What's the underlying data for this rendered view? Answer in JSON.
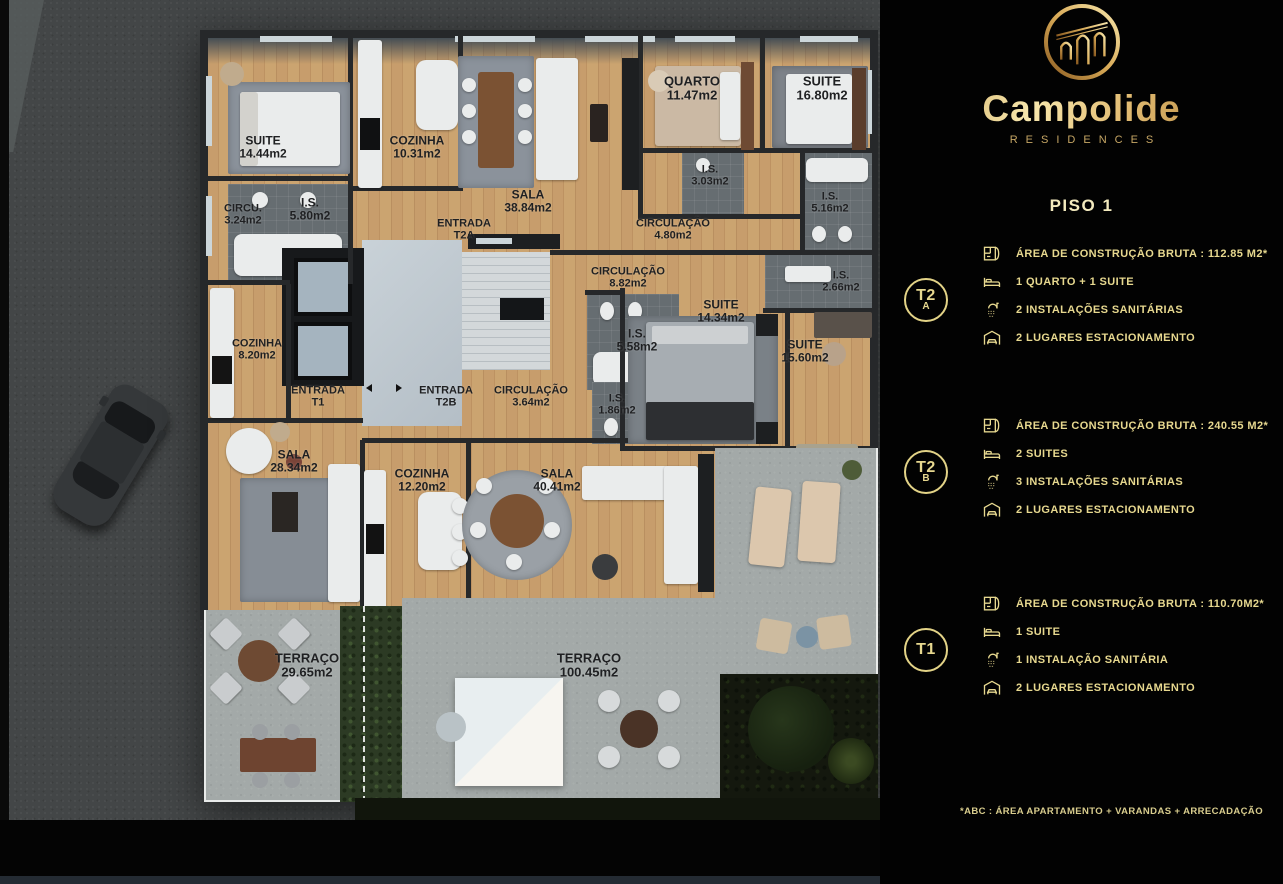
{
  "brand": {
    "name": "Campolide",
    "tagline": "RESIDENCES",
    "logo_icon": "aqueduct-arches-logo"
  },
  "page": {
    "floor_title": "PISO 1",
    "footnote": "*ABC :  ÁREA APARTAMENTO + VARANDAS + ARRECADAÇÃO"
  },
  "colors": {
    "accent_gold": "#e7d88f",
    "logo_gold": "#d3a554",
    "panel_bg": "#020202",
    "wood_floor": "#c49c6b",
    "terrace_concrete": "#a3a9a8"
  },
  "units": [
    {
      "badge_line1": "T2",
      "badge_line2": "A",
      "specs": [
        {
          "icon": "floorplan-icon",
          "text": "ÁREA DE CONSTRUÇÃO BRUTA :  112.85 M2*"
        },
        {
          "icon": "bed-icon",
          "text": "1 QUARTO + 1 SUITE"
        },
        {
          "icon": "shower-icon",
          "text": "2 INSTALAÇÕES SANITÁRIAS"
        },
        {
          "icon": "garage-icon",
          "text": "2 LUGARES ESTACIONAMENTO"
        }
      ]
    },
    {
      "badge_line1": "T2",
      "badge_line2": "B",
      "specs": [
        {
          "icon": "floorplan-icon",
          "text": "ÁREA DE CONSTRUÇÃO BRUTA :  240.55 M2*"
        },
        {
          "icon": "bed-icon",
          "text": "2 SUITES"
        },
        {
          "icon": "shower-icon",
          "text": "3 INSTALAÇÕES SANITÁRIAS"
        },
        {
          "icon": "garage-icon",
          "text": "2 LUGARES ESTACIONAMENTO"
        }
      ]
    },
    {
      "badge_line1": "T1",
      "badge_line2": "",
      "specs": [
        {
          "icon": "floorplan-icon",
          "text": "ÁREA DE CONSTRUÇÃO BRUTA :  110.70M2*"
        },
        {
          "icon": "bed-icon",
          "text": "1 SUITE"
        },
        {
          "icon": "shower-icon",
          "text": "1 INSTALAÇÃO SANITÁRIA"
        },
        {
          "icon": "garage-icon",
          "text": "2 LUGARES ESTACIONAMENTO"
        }
      ]
    }
  ],
  "floorplan": {
    "rooms": [
      {
        "l1": "SUITE",
        "l2": "14.44m2",
        "x": 263,
        "y": 147,
        "size": 12
      },
      {
        "l1": "COZINHA",
        "l2": "10.31m2",
        "x": 417,
        "y": 147,
        "size": 12
      },
      {
        "l1": "SALA",
        "l2": "38.84m2",
        "x": 528,
        "y": 201,
        "size": 12
      },
      {
        "l1": "QUARTO",
        "l2": "11.47m2",
        "x": 692,
        "y": 88,
        "size": 13
      },
      {
        "l1": "SUITE",
        "l2": "16.80m2",
        "x": 822,
        "y": 88,
        "size": 13
      },
      {
        "l1": "CIRCU.",
        "l2": "3.24m2",
        "x": 243,
        "y": 215,
        "size": 11
      },
      {
        "l1": "I.S.",
        "l2": "5.80m2",
        "x": 310,
        "y": 209,
        "size": 12
      },
      {
        "l1": "ENTRADA",
        "l2": "T2A",
        "x": 464,
        "y": 230,
        "size": 11
      },
      {
        "l1": "I.S.",
        "l2": "3.03m2",
        "x": 710,
        "y": 176,
        "size": 11
      },
      {
        "l1": "CIRCULAÇÃO",
        "l2": "4.80m2",
        "x": 673,
        "y": 230,
        "size": 11
      },
      {
        "l1": "I.S.",
        "l2": "5.16m2",
        "x": 830,
        "y": 203,
        "size": 11
      },
      {
        "l1": "CIRCULAÇÃO",
        "l2": "8.82m2",
        "x": 628,
        "y": 278,
        "size": 11
      },
      {
        "l1": "I.S.",
        "l2": "2.66m2",
        "x": 841,
        "y": 282,
        "size": 11
      },
      {
        "l1": "SUITE",
        "l2": "14.34m2",
        "x": 721,
        "y": 311,
        "size": 12
      },
      {
        "l1": "I.S.",
        "l2": "5.58m2",
        "x": 637,
        "y": 340,
        "size": 12
      },
      {
        "l1": "SUITE",
        "l2": "15.60m2",
        "x": 805,
        "y": 351,
        "size": 12
      },
      {
        "l1": "COZINHA",
        "l2": "8.20m2",
        "x": 257,
        "y": 350,
        "size": 11
      },
      {
        "l1": "ENTRADA",
        "l2": "T1",
        "x": 318,
        "y": 397,
        "size": 11
      },
      {
        "l1": "ENTRADA",
        "l2": "T2B",
        "x": 446,
        "y": 397,
        "size": 11
      },
      {
        "l1": "CIRCULAÇÃO",
        "l2": "3.64m2",
        "x": 531,
        "y": 397,
        "size": 11
      },
      {
        "l1": "I.S.",
        "l2": "1.86m2",
        "x": 617,
        "y": 405,
        "size": 11
      },
      {
        "l1": "SALA",
        "l2": "28.34m2",
        "x": 294,
        "y": 461,
        "size": 12
      },
      {
        "l1": "COZINHA",
        "l2": "12.20m2",
        "x": 422,
        "y": 480,
        "size": 12
      },
      {
        "l1": "SALA",
        "l2": "40.41m2",
        "x": 557,
        "y": 480,
        "size": 12
      },
      {
        "l1": "TERRAÇO",
        "l2": "29.65m2",
        "x": 307,
        "y": 665,
        "size": 13
      },
      {
        "l1": "TERRAÇO",
        "l2": "100.45m2",
        "x": 589,
        "y": 665,
        "size": 13
      }
    ]
  }
}
